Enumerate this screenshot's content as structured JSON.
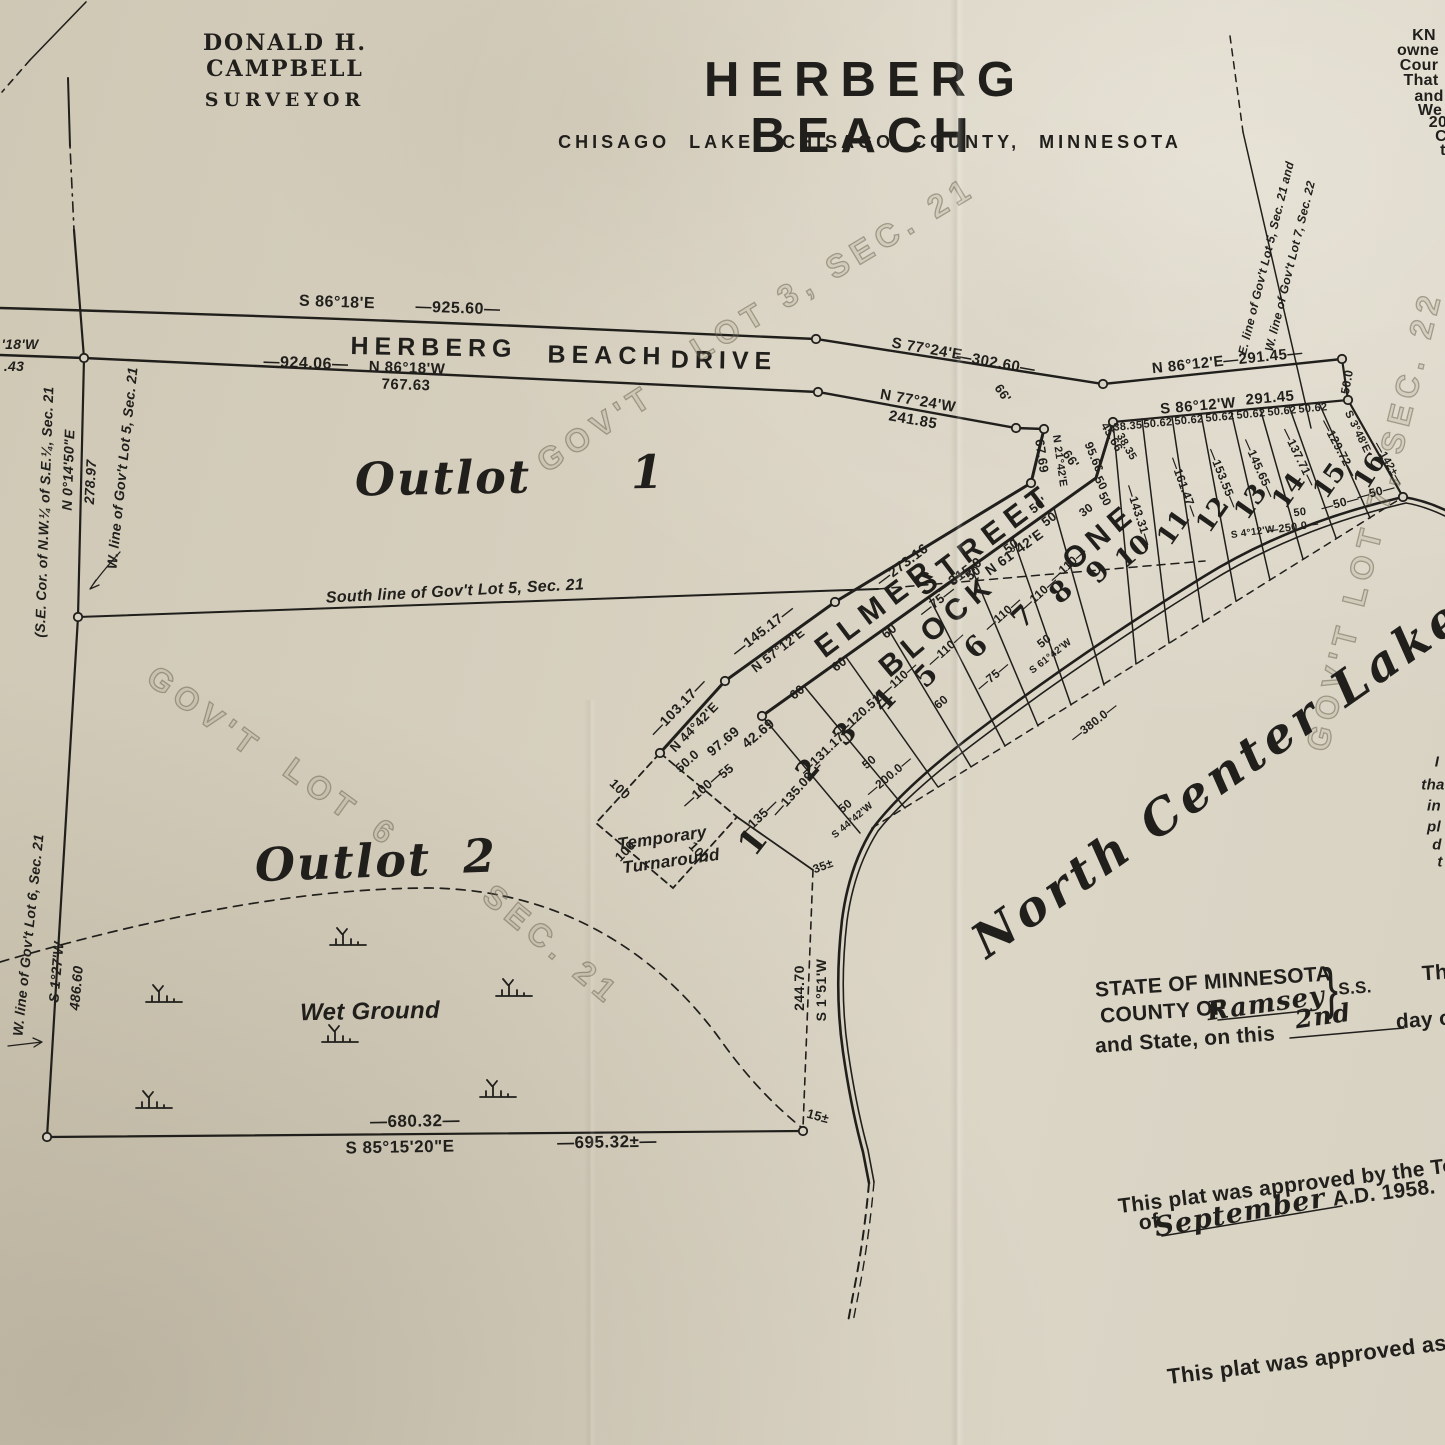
{
  "palette": {
    "paper": "#d7d0c0",
    "ink": "#201f1c",
    "watermark": "#8a8068"
  },
  "header": {
    "surveyor_name": "DONALD H. CAMPBELL",
    "surveyor_title": "SURVEYOR",
    "title": "HERBERG BEACH",
    "subtitle": "CHISAGO LAKE, CHISAGO COUNTY, MINNESOTA"
  },
  "labels": [
    {
      "t": "KN",
      "x": 1424,
      "y": 36,
      "r": 0,
      "s": 16,
      "c": "hp2"
    },
    {
      "t": "owne",
      "x": 1418,
      "y": 51,
      "r": 0,
      "s": 16,
      "c": "hp2"
    },
    {
      "t": "Cour",
      "x": 1419,
      "y": 66,
      "r": 0,
      "s": 16,
      "c": "hp2"
    },
    {
      "t": "That",
      "x": 1421,
      "y": 81,
      "r": 0,
      "s": 16,
      "c": "hp2"
    },
    {
      "t": "and",
      "x": 1429,
      "y": 97,
      "r": 0,
      "s": 16,
      "c": "hp2"
    },
    {
      "t": "We",
      "x": 1430,
      "y": 111,
      "r": 0,
      "s": 16,
      "c": "hp2"
    },
    {
      "t": "20",
      "x": 1438,
      "y": 123,
      "r": 0,
      "s": 16,
      "c": "hp2"
    },
    {
      "t": "C",
      "x": 1441,
      "y": 137,
      "r": 0,
      "s": 16,
      "c": "hp2"
    },
    {
      "t": "t",
      "x": 1443,
      "y": 151,
      "r": 0,
      "s": 16,
      "c": "hp2"
    },
    {
      "t": "S 86°18'E",
      "x": 337,
      "y": 303,
      "r": 2,
      "s": 16,
      "c": "hp"
    },
    {
      "t": "—925.60—",
      "x": 458,
      "y": 309,
      "r": 2,
      "s": 16,
      "c": "hp"
    },
    {
      "t": "HERBERG",
      "x": 434,
      "y": 348,
      "r": 1,
      "s": 25,
      "c": "rd"
    },
    {
      "t": "BEACH",
      "x": 607,
      "y": 356,
      "r": 1,
      "s": 25,
      "c": "rd"
    },
    {
      "t": "DRIVE",
      "x": 724,
      "y": 361,
      "r": 1,
      "s": 25,
      "c": "rd"
    },
    {
      "t": "—924.06—",
      "x": 306,
      "y": 364,
      "r": 2,
      "s": 16,
      "c": "hp"
    },
    {
      "t": "N 86°18'W",
      "x": 407,
      "y": 368,
      "r": 2,
      "s": 15,
      "c": "hp"
    },
    {
      "t": "767.63",
      "x": 406,
      "y": 385,
      "r": 2,
      "s": 15,
      "c": "hp"
    },
    {
      "t": "'18'W",
      "x": 20,
      "y": 344,
      "r": 0,
      "s": 14,
      "c": "hpi"
    },
    {
      "t": ".43",
      "x": 14,
      "y": 366,
      "r": 0,
      "s": 14,
      "c": "hpi"
    },
    {
      "t": "S 77°24'E",
      "x": 927,
      "y": 349,
      "r": 10,
      "s": 15,
      "c": "hp"
    },
    {
      "t": "—302.60—",
      "x": 996,
      "y": 363,
      "r": 10,
      "s": 15,
      "c": "hp"
    },
    {
      "t": "N 77°24'W",
      "x": 918,
      "y": 401,
      "r": 10,
      "s": 15,
      "c": "hp"
    },
    {
      "t": "241.85",
      "x": 913,
      "y": 420,
      "r": 10,
      "s": 15,
      "c": "hp"
    },
    {
      "t": "N 86°12'E",
      "x": 1188,
      "y": 365,
      "r": -6,
      "s": 15,
      "c": "hp"
    },
    {
      "t": "—291.45—",
      "x": 1263,
      "y": 357,
      "r": -6,
      "s": 15,
      "c": "hp"
    },
    {
      "t": "S 86°12'W",
      "x": 1198,
      "y": 406,
      "r": -5,
      "s": 15,
      "c": "hp"
    },
    {
      "t": "291.45",
      "x": 1270,
      "y": 398,
      "r": -5,
      "s": 15,
      "c": "hp"
    },
    {
      "t": "50.0",
      "x": 1347,
      "y": 382,
      "r": -80,
      "s": 12,
      "c": "dim"
    },
    {
      "t": "S 3°48'E",
      "x": 1357,
      "y": 432,
      "r": 64,
      "s": 11,
      "c": "dim"
    },
    {
      "t": "—142±—",
      "x": 1388,
      "y": 464,
      "r": 60,
      "s": 11,
      "c": "dim"
    },
    {
      "t": "38.35",
      "x": 1128,
      "y": 427,
      "r": -5,
      "s": 11,
      "c": "dim"
    },
    {
      "t": "50.62",
      "x": 1158,
      "y": 424,
      "r": -5,
      "s": 11,
      "c": "dim"
    },
    {
      "t": "50.62",
      "x": 1189,
      "y": 421,
      "r": -5,
      "s": 11,
      "c": "dim"
    },
    {
      "t": "50.62",
      "x": 1220,
      "y": 418,
      "r": -5,
      "s": 11,
      "c": "dim"
    },
    {
      "t": "50.62",
      "x": 1251,
      "y": 415,
      "r": -5,
      "s": 11,
      "c": "dim"
    },
    {
      "t": "50.62",
      "x": 1282,
      "y": 412,
      "r": -5,
      "s": 11,
      "c": "dim"
    },
    {
      "t": "50.62",
      "x": 1313,
      "y": 409,
      "r": -5,
      "s": 11,
      "c": "dim"
    },
    {
      "t": "E. line of Gov't Lot 5, Sec. 21 and",
      "x": 1266,
      "y": 258,
      "r": -76,
      "s": 12,
      "c": "hpi"
    },
    {
      "t": "W. line of Gov't Lot 7, Sec. 22",
      "x": 1290,
      "y": 266,
      "r": -76,
      "s": 12,
      "c": "hpi"
    },
    {
      "t": "(S.E. Cor. of N.W.¼ of S.E.¼, Sec. 21",
      "x": 44,
      "y": 512,
      "r": -88,
      "s": 14,
      "c": "hpi"
    },
    {
      "t": "N 0°14'50\"E",
      "x": 68,
      "y": 470,
      "r": -88,
      "s": 14,
      "c": "hpi"
    },
    {
      "t": "278.97",
      "x": 90,
      "y": 482,
      "r": -87,
      "s": 14,
      "c": "hpi"
    },
    {
      "t": "W. line of Gov't Lot 5, Sec. 21",
      "x": 122,
      "y": 468,
      "r": -84,
      "s": 14,
      "c": "hpi"
    },
    {
      "t": "South line of Gov't Lot 5, Sec. 21",
      "x": 455,
      "y": 592,
      "r": -3,
      "s": 16,
      "c": "hpi"
    },
    {
      "t": "Outlot",
      "x": 443,
      "y": 478,
      "r": -1,
      "s": 46,
      "c": "scr"
    },
    {
      "t": "1",
      "x": 648,
      "y": 472,
      "r": -1,
      "s": 46,
      "c": "scr"
    },
    {
      "t": "Outlot",
      "x": 343,
      "y": 862,
      "r": -2,
      "s": 46,
      "c": "scr"
    },
    {
      "t": "2",
      "x": 480,
      "y": 856,
      "r": -2,
      "s": 46,
      "c": "scr"
    },
    {
      "t": "GOV'T",
      "x": 596,
      "y": 428,
      "r": -33,
      "s": 32,
      "c": "wm"
    },
    {
      "t": "LOT 3, SEC. 21",
      "x": 833,
      "y": 268,
      "r": -31,
      "s": 32,
      "c": "wm"
    },
    {
      "t": "GOV'T",
      "x": 205,
      "y": 712,
      "r": 36,
      "s": 32,
      "c": "wm"
    },
    {
      "t": "LOT",
      "x": 322,
      "y": 790,
      "r": 36,
      "s": 32,
      "c": "wm"
    },
    {
      "t": "6",
      "x": 386,
      "y": 833,
      "r": 36,
      "s": 32,
      "c": "wm"
    },
    {
      "t": "SEC. 21",
      "x": 552,
      "y": 945,
      "r": 40,
      "s": 32,
      "c": "wm"
    },
    {
      "t": "GOV'T LOT 7, SEC. 22",
      "x": 1374,
      "y": 520,
      "r": -76,
      "s": 32,
      "c": "wm"
    },
    {
      "t": "ELMER",
      "x": 877,
      "y": 608,
      "r": -37,
      "s": 30,
      "c": "rd2"
    },
    {
      "t": "STREET",
      "x": 985,
      "y": 540,
      "r": -37,
      "s": 30,
      "c": "rd2"
    },
    {
      "t": "—273.16—",
      "x": 908,
      "y": 560,
      "r": -37,
      "s": 14,
      "c": "hp"
    },
    {
      "t": "—315.0—",
      "x": 965,
      "y": 571,
      "r": -36,
      "s": 14,
      "c": "hp"
    },
    {
      "t": "N 61°42'E",
      "x": 1014,
      "y": 552,
      "r": -36,
      "s": 14,
      "c": "hp"
    },
    {
      "t": "—145.17—",
      "x": 763,
      "y": 630,
      "r": -38,
      "s": 14,
      "c": "hp"
    },
    {
      "t": "N 57°12'E",
      "x": 778,
      "y": 650,
      "r": -38,
      "s": 13,
      "c": "hp"
    },
    {
      "t": "—103.17—",
      "x": 678,
      "y": 707,
      "r": -46,
      "s": 14,
      "c": "hp"
    },
    {
      "t": "N 44°42'E",
      "x": 694,
      "y": 727,
      "r": -46,
      "s": 13,
      "c": "hp"
    },
    {
      "t": "67.69",
      "x": 1042,
      "y": 456,
      "r": 82,
      "s": 13,
      "c": "dim"
    },
    {
      "t": "N 21°42'E",
      "x": 1059,
      "y": 461,
      "r": 82,
      "s": 11,
      "c": "dim"
    },
    {
      "t": "66'",
      "x": 1003,
      "y": 393,
      "r": 55,
      "s": 13,
      "c": "dim"
    },
    {
      "t": "66'",
      "x": 1071,
      "y": 459,
      "r": 55,
      "s": 13,
      "c": "dim"
    },
    {
      "t": "95.66",
      "x": 1094,
      "y": 457,
      "r": 68,
      "s": 12,
      "c": "dim"
    },
    {
      "t": "45.66",
      "x": 1112,
      "y": 437,
      "r": 60,
      "s": 12,
      "c": "dim"
    },
    {
      "t": "38.35",
      "x": 1126,
      "y": 447,
      "r": 60,
      "s": 11,
      "c": "dim"
    },
    {
      "t": "50'",
      "x": 1038,
      "y": 505,
      "r": -37,
      "s": 13,
      "c": "dim"
    },
    {
      "t": "50",
      "x": 1101,
      "y": 483,
      "r": 62,
      "s": 12,
      "c": "dim"
    },
    {
      "t": "50",
      "x": 1105,
      "y": 499,
      "r": 62,
      "s": 12,
      "c": "dim"
    },
    {
      "t": "30",
      "x": 1086,
      "y": 510,
      "r": -37,
      "s": 12,
      "c": "dim"
    },
    {
      "t": "50.0",
      "x": 687,
      "y": 761,
      "r": -42,
      "s": 13,
      "c": "dim"
    },
    {
      "t": "—100—",
      "x": 702,
      "y": 789,
      "r": -42,
      "s": 13,
      "c": "dim"
    },
    {
      "t": "100",
      "x": 620,
      "y": 789,
      "r": 44,
      "s": 13,
      "c": "dim"
    },
    {
      "t": "100",
      "x": 625,
      "y": 851,
      "r": -46,
      "s": 13,
      "c": "dim"
    },
    {
      "t": "100",
      "x": 699,
      "y": 852,
      "r": 47,
      "s": 13,
      "c": "dim"
    },
    {
      "t": "Temporary",
      "x": 662,
      "y": 838,
      "r": -8,
      "s": 17,
      "c": "hpi"
    },
    {
      "t": "Turnaround",
      "x": 671,
      "y": 861,
      "r": -8,
      "s": 17,
      "c": "hpi"
    },
    {
      "t": "97.69",
      "x": 723,
      "y": 741,
      "r": -40,
      "s": 14,
      "c": "hp"
    },
    {
      "t": "42.69",
      "x": 758,
      "y": 733,
      "r": -40,
      "s": 14,
      "c": "hp"
    },
    {
      "t": "55",
      "x": 726,
      "y": 771,
      "r": -40,
      "s": 13,
      "c": "dim"
    },
    {
      "t": "—135—",
      "x": 758,
      "y": 818,
      "r": -44,
      "s": 13,
      "c": "dim"
    },
    {
      "t": "—135.09—",
      "x": 797,
      "y": 789,
      "r": -48,
      "s": 13,
      "c": "dim"
    },
    {
      "t": "—131.17—",
      "x": 827,
      "y": 749,
      "r": -44,
      "s": 13,
      "c": "dim"
    },
    {
      "t": "—120.51—",
      "x": 864,
      "y": 710,
      "r": -42,
      "s": 13,
      "c": "dim"
    },
    {
      "t": "60",
      "x": 797,
      "y": 692,
      "r": -38,
      "s": 13,
      "c": "dim"
    },
    {
      "t": "60",
      "x": 839,
      "y": 664,
      "r": -38,
      "s": 13,
      "c": "dim"
    },
    {
      "t": "60",
      "x": 889,
      "y": 631,
      "r": -38,
      "s": 13,
      "c": "dim"
    },
    {
      "t": "—75—",
      "x": 937,
      "y": 601,
      "r": -38,
      "s": 13,
      "c": "dim"
    },
    {
      "t": "50",
      "x": 973,
      "y": 573,
      "r": -38,
      "s": 13,
      "c": "dim"
    },
    {
      "t": "50",
      "x": 1011,
      "y": 546,
      "r": -38,
      "s": 13,
      "c": "dim"
    },
    {
      "t": "50",
      "x": 1049,
      "y": 519,
      "r": -38,
      "s": 13,
      "c": "dim"
    },
    {
      "t": "—110—",
      "x": 899,
      "y": 679,
      "r": -42,
      "s": 12,
      "c": "dim"
    },
    {
      "t": "—110—",
      "x": 946,
      "y": 649,
      "r": -42,
      "s": 12,
      "c": "dim"
    },
    {
      "t": "—110—",
      "x": 1003,
      "y": 614,
      "r": -42,
      "s": 12,
      "c": "dim"
    },
    {
      "t": "—110—",
      "x": 1039,
      "y": 594,
      "r": -42,
      "s": 12,
      "c": "dim"
    },
    {
      "t": "—110—",
      "x": 1068,
      "y": 565,
      "r": -42,
      "s": 12,
      "c": "dim"
    },
    {
      "t": "60",
      "x": 941,
      "y": 702,
      "r": -40,
      "s": 12,
      "c": "dim"
    },
    {
      "t": "—75—",
      "x": 993,
      "y": 676,
      "r": -40,
      "s": 12,
      "c": "dim"
    },
    {
      "t": "—200.0—",
      "x": 889,
      "y": 776,
      "r": -40,
      "s": 12,
      "c": "dim"
    },
    {
      "t": "S 44°42'W",
      "x": 853,
      "y": 821,
      "r": -40,
      "s": 10,
      "c": "dim"
    },
    {
      "t": "50",
      "x": 845,
      "y": 806,
      "r": -40,
      "s": 12,
      "c": "dim"
    },
    {
      "t": "50",
      "x": 869,
      "y": 762,
      "r": -40,
      "s": 12,
      "c": "dim"
    },
    {
      "t": "35±",
      "x": 823,
      "y": 866,
      "r": -20,
      "s": 12,
      "c": "dim"
    },
    {
      "t": "50",
      "x": 1044,
      "y": 641,
      "r": -38,
      "s": 12,
      "c": "dim"
    },
    {
      "t": "S 61°42'W",
      "x": 1051,
      "y": 657,
      "r": -38,
      "s": 10,
      "c": "dim"
    },
    {
      "t": "—380.0—",
      "x": 1094,
      "y": 722,
      "r": -38,
      "s": 12,
      "c": "dim"
    },
    {
      "t": "—50—",
      "x": 1340,
      "y": 503,
      "r": -15,
      "s": 12,
      "c": "dim"
    },
    {
      "t": "—50—",
      "x": 1376,
      "y": 492,
      "r": -15,
      "s": 12,
      "c": "dim"
    },
    {
      "t": "50",
      "x": 1300,
      "y": 513,
      "r": -8,
      "s": 11,
      "c": "dim"
    },
    {
      "t": "—250.0—",
      "x": 1293,
      "y": 528,
      "r": -8,
      "s": 11,
      "c": "dim"
    },
    {
      "t": "S 4°12'W",
      "x": 1253,
      "y": 533,
      "r": -8,
      "s": 10,
      "c": "dim"
    },
    {
      "t": "—143.31—",
      "x": 1139,
      "y": 515,
      "r": 72,
      "s": 12,
      "c": "dim"
    },
    {
      "t": "—161.47—",
      "x": 1184,
      "y": 487,
      "r": 70,
      "s": 12,
      "c": "dim"
    },
    {
      "t": "—153.55—",
      "x": 1223,
      "y": 478,
      "r": 68,
      "s": 12,
      "c": "dim"
    },
    {
      "t": "—145.65—",
      "x": 1259,
      "y": 468,
      "r": 66,
      "s": 12,
      "c": "dim"
    },
    {
      "t": "—137.71—",
      "x": 1299,
      "y": 457,
      "r": 64,
      "s": 12,
      "c": "dim"
    },
    {
      "t": "—129.72—",
      "x": 1339,
      "y": 448,
      "r": 62,
      "s": 12,
      "c": "dim"
    },
    {
      "t": "BLOCK",
      "x": 938,
      "y": 626,
      "r": -40,
      "s": 30,
      "c": "bl"
    },
    {
      "t": "ONE",
      "x": 1100,
      "y": 537,
      "r": -40,
      "s": 30,
      "c": "bl"
    },
    {
      "t": "1",
      "x": 753,
      "y": 842,
      "r": -52,
      "s": 34,
      "c": "lot"
    },
    {
      "t": "2",
      "x": 808,
      "y": 770,
      "r": -50,
      "s": 28,
      "c": "lot"
    },
    {
      "t": "3",
      "x": 845,
      "y": 734,
      "r": -48,
      "s": 28,
      "c": "lot"
    },
    {
      "t": "4",
      "x": 884,
      "y": 701,
      "r": -46,
      "s": 28,
      "c": "lot"
    },
    {
      "t": "5",
      "x": 926,
      "y": 676,
      "r": -45,
      "s": 28,
      "c": "lot"
    },
    {
      "t": "6",
      "x": 976,
      "y": 647,
      "r": -44,
      "s": 28,
      "c": "lot"
    },
    {
      "t": "7",
      "x": 1023,
      "y": 617,
      "r": -43,
      "s": 28,
      "c": "lot"
    },
    {
      "t": "8",
      "x": 1061,
      "y": 592,
      "r": -42,
      "s": 28,
      "c": "lot"
    },
    {
      "t": "9",
      "x": 1098,
      "y": 572,
      "r": -45,
      "s": 28,
      "c": "lot"
    },
    {
      "t": "10",
      "x": 1133,
      "y": 552,
      "r": -40,
      "s": 26,
      "c": "lot"
    },
    {
      "t": "11",
      "x": 1174,
      "y": 528,
      "r": -55,
      "s": 26,
      "c": "lot"
    },
    {
      "t": "12",
      "x": 1213,
      "y": 515,
      "r": -55,
      "s": 26,
      "c": "lot"
    },
    {
      "t": "13",
      "x": 1251,
      "y": 502,
      "r": -55,
      "s": 26,
      "c": "lot"
    },
    {
      "t": "14",
      "x": 1289,
      "y": 491,
      "r": -55,
      "s": 26,
      "c": "lot"
    },
    {
      "t": "15",
      "x": 1330,
      "y": 481,
      "r": -55,
      "s": 26,
      "c": "lot"
    },
    {
      "t": "16",
      "x": 1370,
      "y": 471,
      "r": -58,
      "s": 26,
      "c": "lot"
    },
    {
      "t": "North Center Lake",
      "x": 1218,
      "y": 778,
      "r": -35,
      "s": 48,
      "c": "lake"
    },
    {
      "t": "—680.32—",
      "x": 415,
      "y": 1121,
      "r": -1,
      "s": 17,
      "c": "hp"
    },
    {
      "t": "S 85°15'20\"E",
      "x": 400,
      "y": 1147,
      "r": -1,
      "s": 17,
      "c": "hp"
    },
    {
      "t": "—695.32±—",
      "x": 607,
      "y": 1142,
      "r": -1,
      "s": 17,
      "c": "hp"
    },
    {
      "t": "15±",
      "x": 818,
      "y": 1116,
      "r": 15,
      "s": 13,
      "c": "dim"
    },
    {
      "t": "244.70",
      "x": 799,
      "y": 988,
      "r": -90,
      "s": 14,
      "c": "hp"
    },
    {
      "t": "S 1°51'W",
      "x": 821,
      "y": 990,
      "r": -90,
      "s": 14,
      "c": "hp"
    },
    {
      "t": "W. line of Gov't Lot 6, Sec. 21",
      "x": 28,
      "y": 935,
      "r": -84,
      "s": 14,
      "c": "hpi"
    },
    {
      "t": "S 1°27'W",
      "x": 56,
      "y": 972,
      "r": -85,
      "s": 14,
      "c": "hpi"
    },
    {
      "t": "486.60",
      "x": 76,
      "y": 988,
      "r": -85,
      "s": 14,
      "c": "hpi"
    },
    {
      "t": "Wet Ground",
      "x": 370,
      "y": 1012,
      "r": -1,
      "s": 24,
      "c": "hpi"
    },
    {
      "t": "I",
      "x": 1437,
      "y": 762,
      "r": 0,
      "s": 15,
      "c": "hpi"
    },
    {
      "t": "tha",
      "x": 1433,
      "y": 785,
      "r": 0,
      "s": 15,
      "c": "hpi"
    },
    {
      "t": "in",
      "x": 1434,
      "y": 806,
      "r": 0,
      "s": 15,
      "c": "hpi"
    },
    {
      "t": "pl",
      "x": 1434,
      "y": 827,
      "r": 0,
      "s": 15,
      "c": "hpi"
    },
    {
      "t": "d",
      "x": 1437,
      "y": 845,
      "r": 0,
      "s": 15,
      "c": "hpi"
    },
    {
      "t": "t",
      "x": 1440,
      "y": 862,
      "r": 0,
      "s": 15,
      "c": "hpi"
    },
    {
      "t": "STATE OF MINNESOTA",
      "x": 1213,
      "y": 982,
      "r": -4,
      "s": 21,
      "c": "hp2"
    },
    {
      "t": "}",
      "x": 1331,
      "y": 989,
      "r": -2,
      "s": 42,
      "c": "hp2 brace"
    },
    {
      "t": "S.S.",
      "x": 1355,
      "y": 988,
      "r": -4,
      "s": 17,
      "c": "hp2"
    },
    {
      "t": "Th",
      "x": 1435,
      "y": 973,
      "r": -4,
      "s": 21,
      "c": "hp2"
    },
    {
      "t": "COUNTY OF",
      "x": 1163,
      "y": 1012,
      "r": -4,
      "s": 21,
      "c": "hp2"
    },
    {
      "t": "Ramsey",
      "x": 1266,
      "y": 1004,
      "r": -8,
      "s": 26,
      "c": "cur"
    },
    {
      "t": "2nd",
      "x": 1323,
      "y": 1016,
      "r": -8,
      "s": 25,
      "c": "cur"
    },
    {
      "t": "and State, on this",
      "x": 1185,
      "y": 1040,
      "r": -4,
      "s": 21,
      "c": "hp2"
    },
    {
      "t": "day o",
      "x": 1424,
      "y": 1020,
      "r": -4,
      "s": 21,
      "c": "hp2"
    },
    {
      "t": "This plat was approved by the Tow",
      "x": 1295,
      "y": 1185,
      "r": -7,
      "s": 21,
      "c": "hp2"
    },
    {
      "t": "of",
      "x": 1149,
      "y": 1222,
      "r": -7,
      "s": 21,
      "c": "hp2"
    },
    {
      "t": "September",
      "x": 1240,
      "y": 1213,
      "r": -10,
      "s": 27,
      "c": "cur"
    },
    {
      "t": "A.D. 1958.",
      "x": 1384,
      "y": 1193,
      "r": -7,
      "s": 21,
      "c": "hp2"
    },
    {
      "t": "This plat was approved as",
      "x": 1307,
      "y": 1360,
      "r": -7,
      "s": 22,
      "c": "hp2"
    }
  ]
}
